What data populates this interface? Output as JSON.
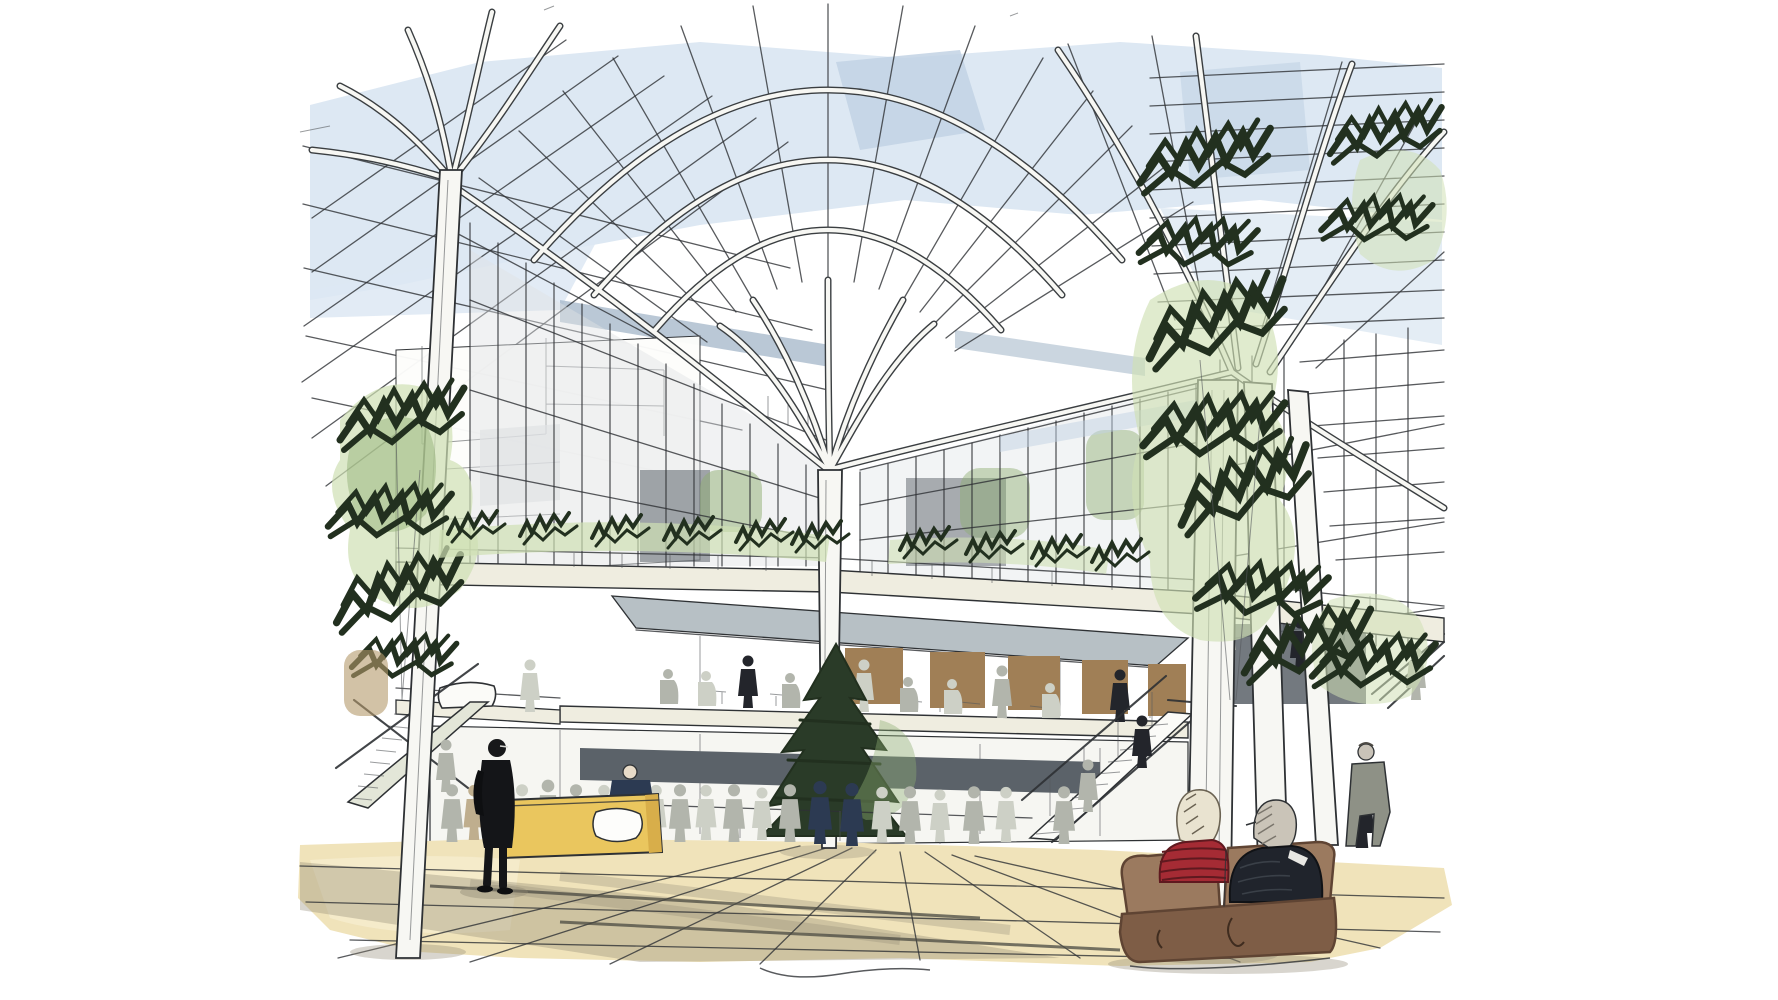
{
  "meta": {
    "subject": "Architectural concept sketch of a glass-roofed atrium with tree-like branching white columns",
    "medium": "pen line work with watercolor wash",
    "view": "interior eye-level perspective across a paved atrium court"
  },
  "scene": {
    "elements": [
      "glass fan-vault roof with radial glazing bars",
      "three clusters of white tree-like branching columns",
      "tall dark green trees inside the atrium",
      "two-storey glazed galleries with planted balconies",
      "first-floor cafe terrace with awning and timber panels",
      "left and right staircases with handrails",
      "crowd of sketched figures on the ground floor",
      "yellow reception desk with attendant",
      "man in black standing in foreground left",
      "brown two-seat sofa in foreground with two seated people",
      "sand-coloured paved floor with shadow streaks"
    ],
    "people": {
      "seated_on_sofa": 2,
      "sofa_left_person": "light-haired, red striped sweater",
      "sofa_right_person": "grey-haired, dark jacket and glasses",
      "foreground_left": "man dressed in black with glasses",
      "desk_attendant": "figure in dark navy behind yellow desk"
    }
  },
  "palette": {
    "paper": "#ffffff",
    "ink": "#2e3134",
    "ink-soft": "#55595c",
    "rib-case": "#3a3e41",
    "white-struct": "#f7f7f3",
    "sky": "#dde8f3",
    "sky-deep": "#c2d2e4",
    "glass-slate": "#a9bacc",
    "wash-gray": "#dfe3e5",
    "slate-dark": "#5b6269",
    "gray-mid": "#9aa1a6",
    "cream": "#efede0",
    "floor": "#f0e3ba",
    "floor-light": "#f8f0d6",
    "floor-shadow": "#8f8874",
    "tan": "#b49a6a",
    "desk-yellow": "#eac65e",
    "desk-yellow-dark": "#d8ae4a",
    "brown-panel": "#a07f56",
    "sofa": "#9b7a5f",
    "sofa-dark": "#7e5d46",
    "sofa-darker": "#5f4433",
    "red": "#a52b34",
    "red-dark": "#5f191f",
    "green-light": "#cfe0b4",
    "green-mid": "#8fae72",
    "green-dark": "#22301f",
    "awning": "#b7c0c5",
    "figure-gray": "#b2b5ac",
    "figure-dark": "#23252b",
    "navy": "#2c3a52"
  }
}
